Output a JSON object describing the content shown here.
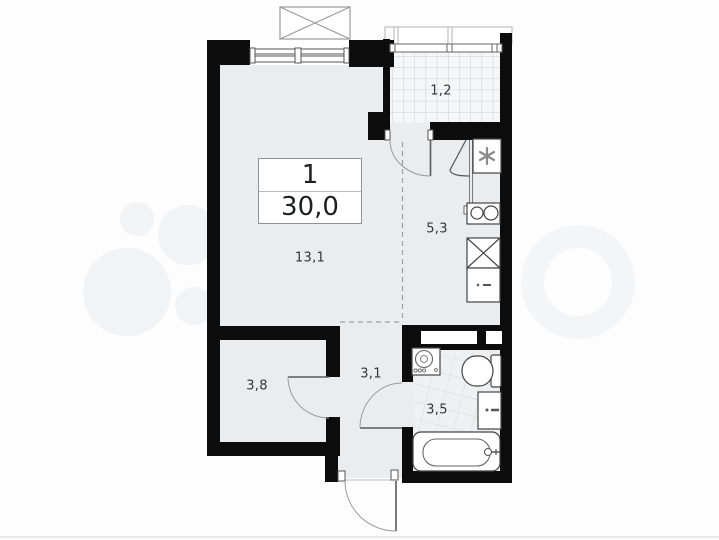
{
  "source": {
    "brand_watermark": "Avito"
  },
  "plan": {
    "type": "apartment-floor-plan",
    "info_box": {
      "rooms_count": "1",
      "total_area": "30,0"
    },
    "rooms": [
      {
        "name": "loggia",
        "area_label": "1,2"
      },
      {
        "name": "kitchen",
        "area_label": "5,3"
      },
      {
        "name": "living-room",
        "area_label": "13,1"
      },
      {
        "name": "wardrobe",
        "area_label": "3,8"
      },
      {
        "name": "hallway",
        "area_label": "3,1"
      },
      {
        "name": "bathroom",
        "area_label": "3,5"
      }
    ],
    "fixtures": [
      "ventilation-shaft",
      "cooktop-2-burner",
      "kitchen-sink",
      "kitchen-cabinet",
      "washing-machine",
      "toilet",
      "vanity-sink",
      "bathtub",
      "balcony-door",
      "wardrobe-door",
      "bathroom-door",
      "entrance-door",
      "window",
      "balcony-glazing",
      "upper-balcony-outline",
      "upper-floor-balcony-box"
    ],
    "colors": {
      "wall": "#0c0c0c",
      "room_fill": "#e9edef",
      "balcony_fill": "#f4f6f7",
      "bathroom_fill": "#eef1f2",
      "background": "#ffffff",
      "watermark": "#f3f4f5"
    }
  }
}
